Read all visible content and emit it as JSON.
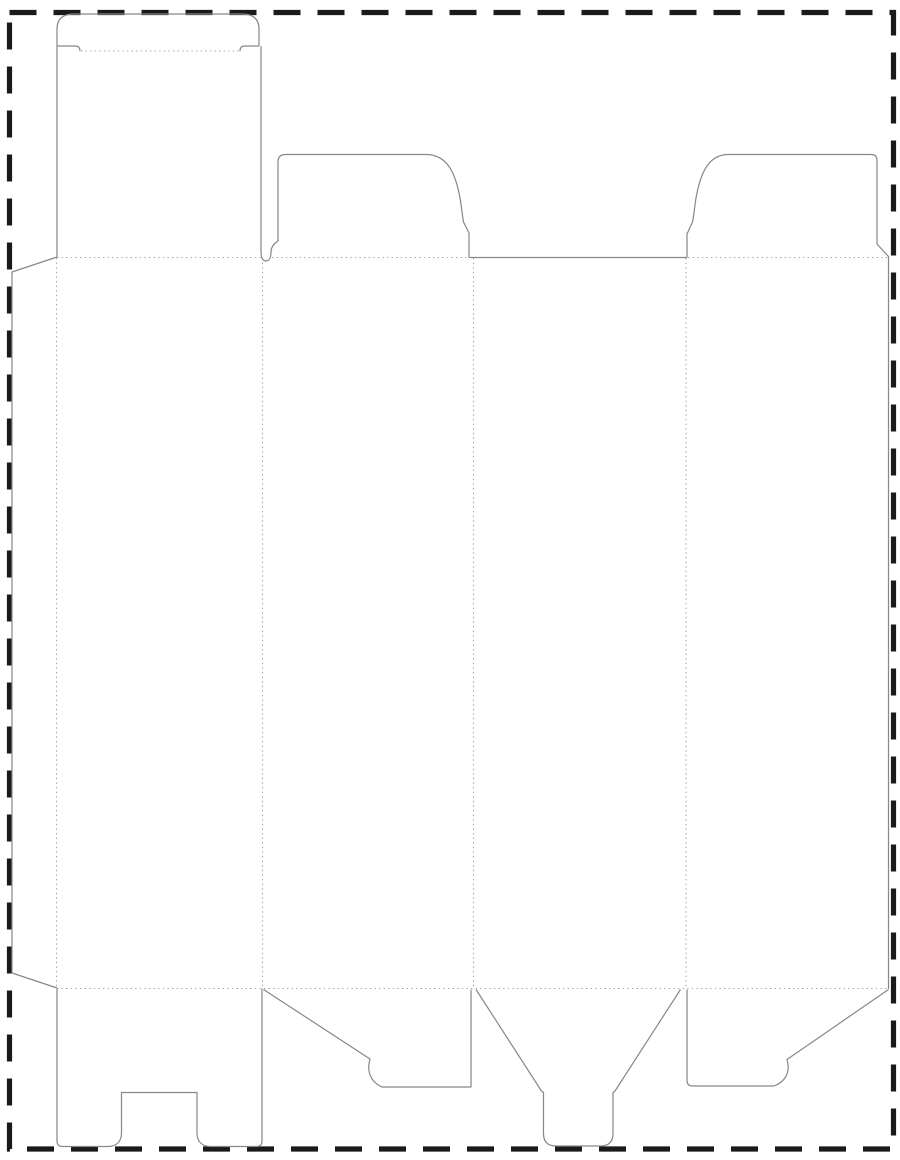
{
  "artboard": {
    "width": 900,
    "height": 1160,
    "background": "#fcfcfc",
    "description": "Blank folding-carton dieline template with cut and fold lines inside a dashed trim border"
  },
  "border": {
    "color": "#1a1a1a",
    "stroke_width": 5.2,
    "dash": 27,
    "gap": 17,
    "path": "M 9.5,12.5 L 893.5,12.5 L 893.5,1149 L 9.5,1149 Z"
  },
  "line_styles": {
    "cut": {
      "color": "#878787",
      "stroke_width": 1.2
    },
    "fold": {
      "color": "#a6a6a6",
      "stroke_width": 1.1,
      "dasharray": "1.4 3.2"
    }
  },
  "dieline": {
    "cut_paths": [
      {
        "name": "tuck-flap-outline",
        "d": "M 57,46 L 57,29 Q 57,14 74,14 L 242,14 Q 259,14 259,29 L 259,46"
      },
      {
        "name": "tuck-flap-left-shoulder",
        "d": "M 57,46 L 75,46 Q 80,46 80,51"
      },
      {
        "name": "tuck-flap-right-shoulder",
        "d": "M 259,46 L 245,46 Q 240,46 240,51"
      },
      {
        "name": "top-panel-left-edge",
        "d": "M 57,46 L 57,257"
      },
      {
        "name": "left-dust-flap-outline",
        "d": "M 261,46 L 261,251 C 261,257.5 262.5,261 266,261 C 269.5,261 271,257 271,252 C 271,247 274,243.5 278,241 L 278,162 Q 278,154.5 285.5,154.5 L 428,154.5 C 449,156 456,176 460,198 C 461.5,206 462.2,215 463.5,222 L 469,233 L 469,257.5"
      },
      {
        "name": "glue-flap-outline",
        "d": "M 57,257 L 12,272 L 12,973 L 57,988"
      },
      {
        "name": "panel3-top-edge",
        "d": "M 469,257.5 L 687,257.5"
      },
      {
        "name": "right-dust-flap-outline",
        "d": "M 687,257.5 L 687,234 L 692.5,222 C 694,215 694.7,206 696,198 C 700,176 707,154.8 728,154.5 L 871,154.5 Q 877,154.5 877,160.5 L 877,244 L 888.5,256.5"
      },
      {
        "name": "right-blank-edge",
        "d": "M 888.5,256.5 L 888.5,989"
      },
      {
        "name": "bottom-flap-1-notched",
        "d": "M 57,988.5 L 57,1141 Q 57,1146.5 62.5,1146.5 L 108,1146.5 C 116,1146.5 121.5,1142 121.5,1133 L 121.5,1092.5 L 197,1092.5 L 197,1133 C 197,1142 202.5,1146.5 210.5,1146.5 L 256.5,1146.5 Q 262,1146.5 262,1141 L 262,988.5"
      },
      {
        "name": "bottom-flap-2-angled",
        "d": "M 263.5,989.5 L 370,1059 C 366.5,1071 370,1081.5 382,1087 L 471,1087 L 471,989.5"
      },
      {
        "name": "bottom-flap-3-tongue",
        "d": "M 476,989.5 L 541.5,1091 L 543.5,1092.5 L 543.5,1133.5 Q 543.5,1146 556,1146 L 600.5,1146 Q 613,1146 613,1133.5 L 613,1092.5 L 615,1091 L 680.5,989.5"
      },
      {
        "name": "bottom-flap-4-angled",
        "d": "M 687,989.5 L 687,1080.5 Q 687,1086 692.5,1086 L 774,1086 C 786,1081.5 790.5,1071.5 787,1059.5 L 888.5,989.5"
      }
    ],
    "fold_paths": [
      {
        "name": "tuck-flap-fold",
        "d": "M 81,51 L 240,51"
      },
      {
        "name": "top-fold-panel-1",
        "d": "M 57,257.5 L 261,257.5"
      },
      {
        "name": "top-fold-panel-2",
        "d": "M 272,257.5 L 468,257.5"
      },
      {
        "name": "top-fold-panel-4",
        "d": "M 688,257.5 L 887,257.5"
      },
      {
        "name": "bottom-fold-line",
        "d": "M 57,988.5 L 888,988.5"
      },
      {
        "name": "vertical-fold-glue-flap",
        "d": "M 56.5,258 L 56.5,988"
      },
      {
        "name": "vertical-fold-panel-1-2",
        "d": "M 262.5,258 L 262.5,988"
      },
      {
        "name": "vertical-fold-panel-2-3",
        "d": "M 473.5,258 L 473.5,988"
      },
      {
        "name": "vertical-fold-panel-3-4",
        "d": "M 686,258 L 686,988"
      }
    ]
  }
}
